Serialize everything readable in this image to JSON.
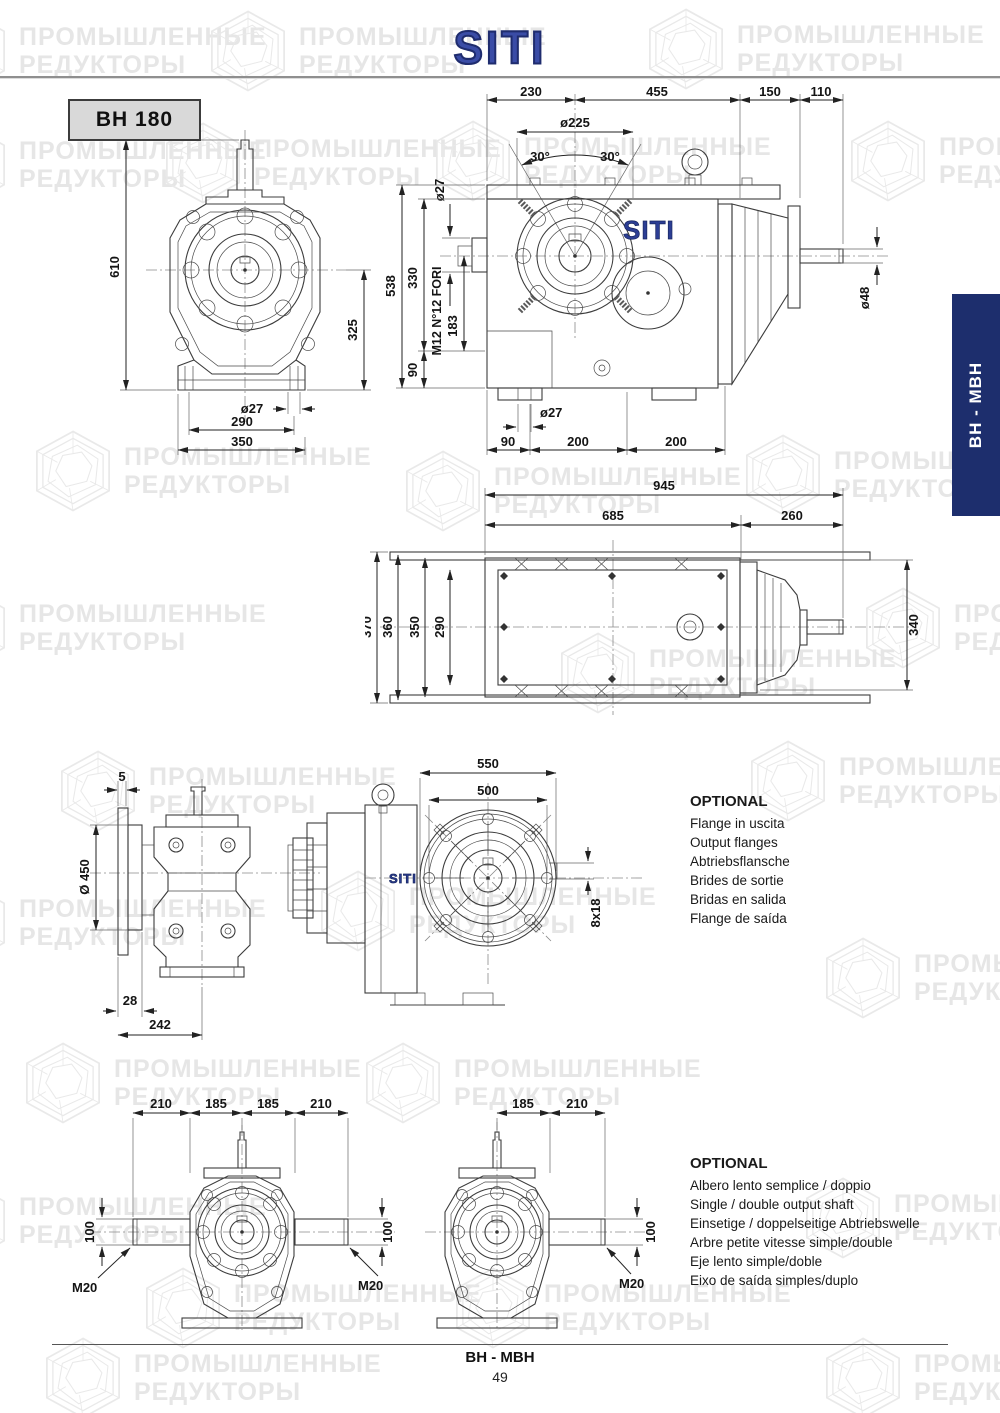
{
  "header": {
    "logo": "SITI"
  },
  "model_label": "BH 180",
  "side_tab": {
    "label": "BH - MBH"
  },
  "watermark": {
    "line1": "ПРОМЫШЛЕННЫЕ",
    "line2": "РЕДУКТОРЫ"
  },
  "drawings": {
    "front_view": {
      "h_total": "610",
      "h_shaft": "325",
      "hole_d": "ø27",
      "w_holes": "290",
      "w_total": "350"
    },
    "side_view": {
      "logo": "SITI",
      "len_1": "230",
      "len_2": "455",
      "len_3": "150",
      "len_4": "110",
      "flange_d": "ø225",
      "angle_l": "30°",
      "angle_r": "30°",
      "input_d": "ø27",
      "h_total": "538",
      "h_upper": "330",
      "h_lower": "90",
      "h_mid": "183",
      "holes_note": "M12 N°12 FORI",
      "shaft_d": "ø48",
      "foot_hole_d": "ø27",
      "foot_1": "90",
      "foot_2": "200",
      "foot_3": "200"
    },
    "top_view": {
      "len_total": "945",
      "len_body": "685",
      "len_motor": "260",
      "w_1": "370",
      "w_2": "360",
      "w_3": "350",
      "w_4": "290",
      "motor_h": "340"
    },
    "flange_side": {
      "gap": "5",
      "flange_d": "Ø 450",
      "offset": "28",
      "depth": "242"
    },
    "flange_front": {
      "outer_d": "550",
      "bolt_circle_d": "500",
      "slot": "8x18",
      "logo": "SITI"
    },
    "double_shaft": {
      "len_1": "210",
      "len_2": "185",
      "len_3": "185",
      "len_4": "210",
      "shaft_l_d": "100",
      "shaft_r_d": "100",
      "thread_l": "M20",
      "thread_r": "M20"
    },
    "single_shaft": {
      "len_1": "185",
      "len_2": "210",
      "shaft_d": "100",
      "thread": "M20"
    }
  },
  "optional_flanges": {
    "title": "OPTIONAL",
    "lines": [
      "Flange in uscita",
      "Output flanges",
      "Abtriebsflansche",
      "Brides de sortie",
      "Bridas en salida",
      "Flange de saída"
    ]
  },
  "optional_shafts": {
    "title": "OPTIONAL",
    "lines": [
      "Albero lento semplice / doppio",
      "Single / double output shaft",
      "Einsetige / doppelseitige Abtriebswelle",
      "Arbre petite vitesse simple/double",
      "Eje lento simple/doble",
      "Eixo de saída simples/duplo"
    ]
  },
  "footer": {
    "title": "BH - MBH",
    "page": "49"
  }
}
